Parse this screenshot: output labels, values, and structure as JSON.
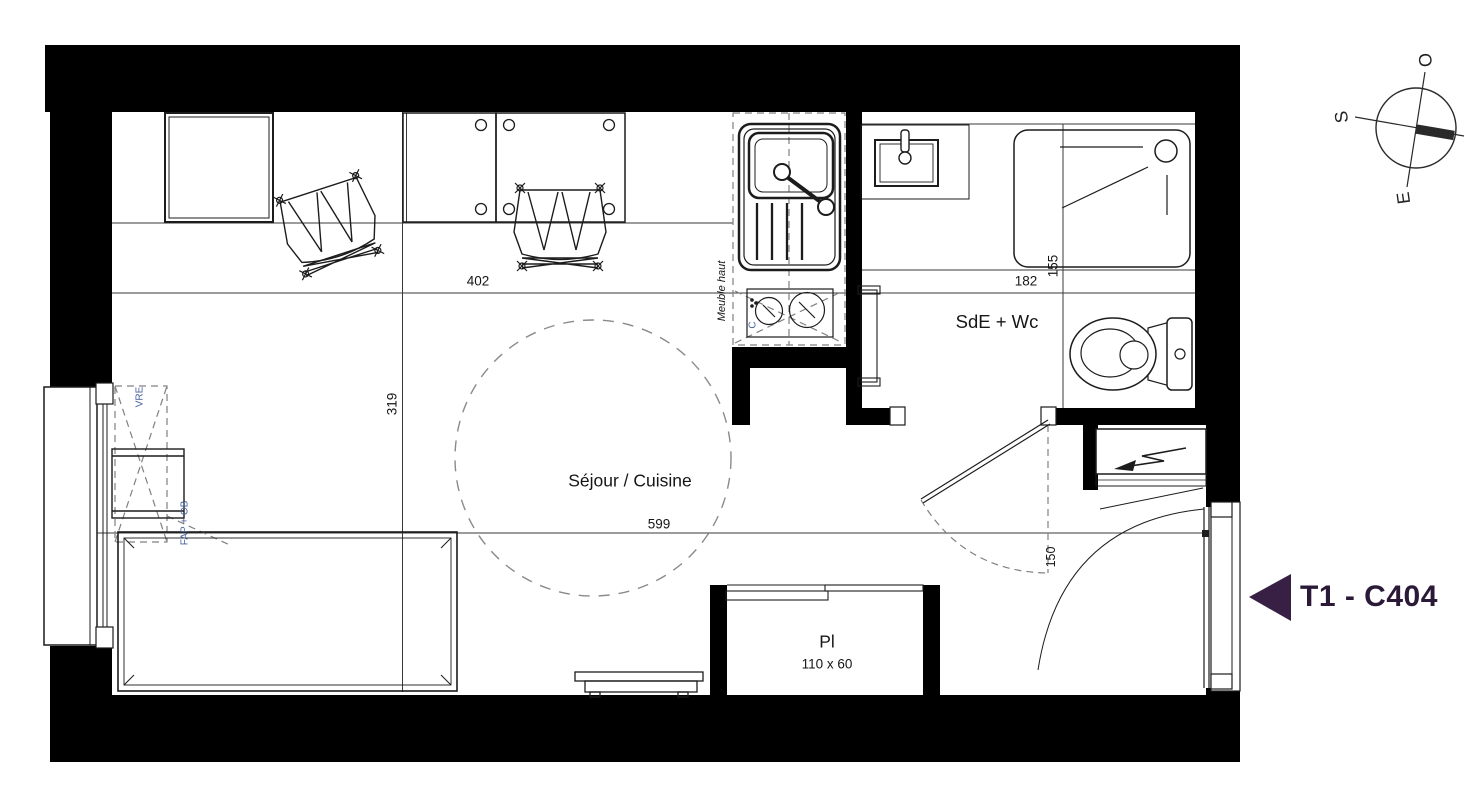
{
  "unit": {
    "label": "T1 - C404"
  },
  "rooms": {
    "living": "Séjour / Cuisine",
    "bathroom": "SdE + Wc",
    "closet": "Pl",
    "closet_size": "110 x 60"
  },
  "dimensions": {
    "living_width": "402",
    "living_depth": "319",
    "living_length": "599",
    "bathroom_width": "182",
    "shower_depth": "155",
    "entry": "150"
  },
  "annotations": {
    "upper_cabinet": "Meuble haut",
    "cooktop": "C",
    "window_top": "VRE",
    "window_bottom": "FAP + OB"
  },
  "compass": {
    "west": "O",
    "south": "S",
    "east": "E"
  },
  "colors": {
    "marker": "#382044",
    "label_text": "#2a1a38",
    "annotation": "#44609c",
    "wall": "#000000",
    "line": "#1c1c1c",
    "dash": "#808080"
  }
}
